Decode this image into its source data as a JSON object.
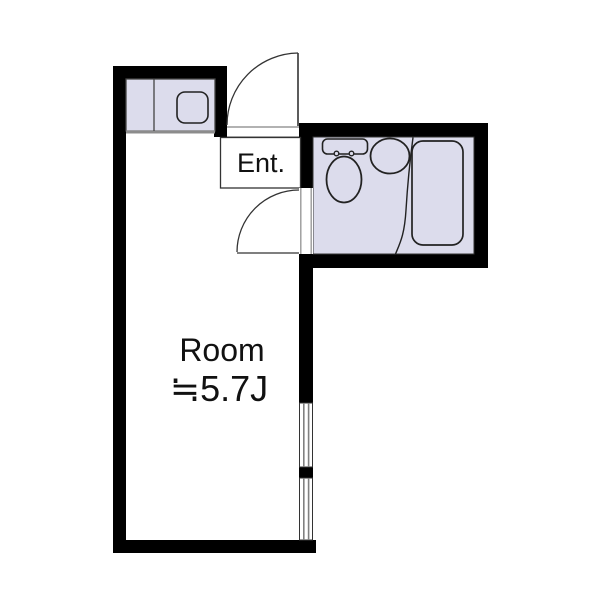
{
  "floor_plan": {
    "entrance_label": "Ent.",
    "room_label": "Room",
    "room_area_label": "≒5.7J",
    "visible_rooms": [
      "entrance",
      "main-room-5.7-tatami",
      "bathroom",
      "kitchenette"
    ],
    "fixtures": [
      "kitchen-counter",
      "kitchen-sink",
      "toilet",
      "wash-basin",
      "bathtub"
    ],
    "door_count": 2,
    "window_segment_count": 2
  },
  "colors": {
    "wall": "#000000",
    "fixture_fill": "#dcdcec",
    "outline": "#222222",
    "gray_line": "#8c8c8c",
    "threshold_line": "#999999",
    "background": "#ffffff",
    "text": "#111111"
  }
}
